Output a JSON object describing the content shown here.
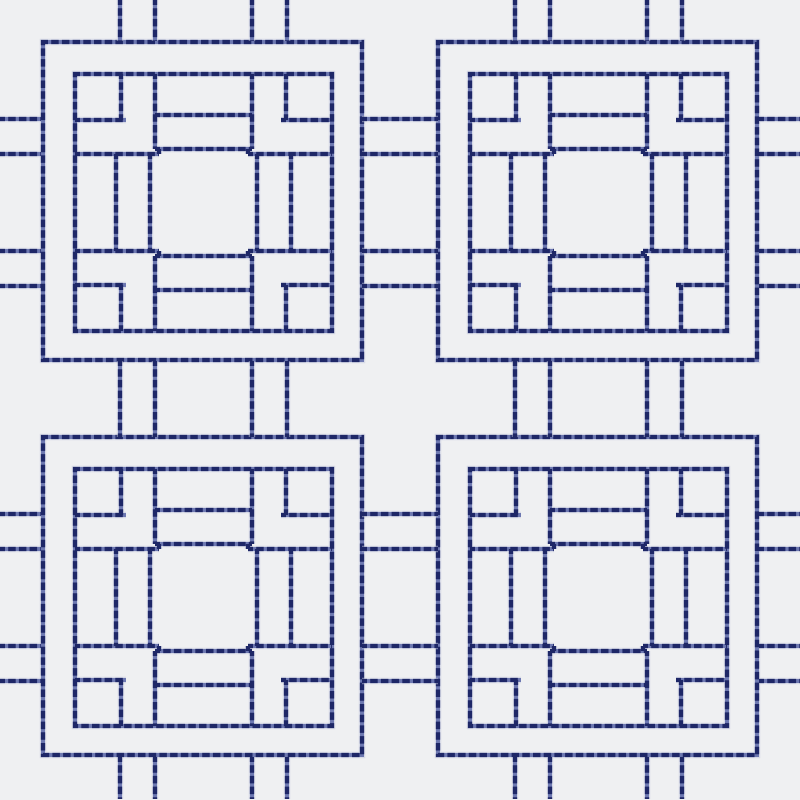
{
  "canvas": {
    "width": 800,
    "height": 800,
    "background": "#eff0f2"
  },
  "thread": {
    "halo_color": "#c5cbdf",
    "halo_width": 6.5,
    "halo_opacity": 0.55,
    "base_color": "#6d78b1",
    "base_width": 4.0,
    "dash_color": "#1e2767",
    "dash_width": 4.3,
    "dash_pattern": "7.5 3.2",
    "dash_offset": 2.5
  },
  "motif": {
    "outer_rect": [
      0,
      0,
      319,
      318
    ],
    "inner_rect": [
      32,
      32,
      257,
      257
    ],
    "segments": [
      [
        78,
        32,
        78,
        78
      ],
      [
        32,
        78,
        83,
        78
      ],
      [
        112,
        32,
        112,
        107
      ],
      [
        32,
        112,
        116,
        112
      ],
      [
        116,
        107,
        116,
        112
      ],
      [
        243,
        32,
        243,
        78
      ],
      [
        238,
        78,
        289,
        78
      ],
      [
        209,
        32,
        209,
        107
      ],
      [
        205,
        112,
        289,
        112
      ],
      [
        205,
        107,
        205,
        112
      ],
      [
        78,
        243,
        78,
        289
      ],
      [
        32,
        243,
        83,
        243
      ],
      [
        112,
        214,
        112,
        289
      ],
      [
        32,
        209,
        116,
        209
      ],
      [
        116,
        209,
        116,
        214
      ],
      [
        243,
        243,
        243,
        289
      ],
      [
        238,
        243,
        289,
        243
      ],
      [
        209,
        214,
        209,
        289
      ],
      [
        205,
        209,
        289,
        209
      ],
      [
        205,
        209,
        205,
        214
      ],
      [
        112,
        73,
        209,
        73
      ],
      [
        112,
        107,
        209,
        107
      ],
      [
        112,
        248,
        209,
        248
      ],
      [
        112,
        214,
        209,
        214
      ],
      [
        73,
        112,
        73,
        209
      ],
      [
        107,
        112,
        107,
        209
      ],
      [
        248,
        112,
        248,
        209
      ],
      [
        214,
        112,
        214,
        209
      ]
    ]
  },
  "motif_origins": [
    [
      43,
      42
    ],
    [
      438,
      42
    ],
    [
      43,
      437
    ],
    [
      438,
      437
    ]
  ],
  "motif_names": [
    "top-left",
    "top-right",
    "bottom-left",
    "bottom-right"
  ],
  "links": {
    "gap_connectors_horizontal": [
      [
        362,
        119,
        438,
        119
      ],
      [
        362,
        154,
        438,
        154
      ],
      [
        362,
        251,
        438,
        251
      ],
      [
        362,
        286,
        438,
        286
      ],
      [
        362,
        514,
        438,
        514
      ],
      [
        362,
        549,
        438,
        549
      ],
      [
        362,
        646,
        438,
        646
      ],
      [
        362,
        681,
        438,
        681
      ]
    ],
    "gap_connectors_vertical": [
      [
        120,
        361,
        120,
        437
      ],
      [
        155,
        361,
        155,
        437
      ],
      [
        252,
        361,
        252,
        437
      ],
      [
        287,
        361,
        287,
        437
      ],
      [
        515,
        361,
        515,
        437
      ],
      [
        550,
        361,
        550,
        437
      ],
      [
        647,
        361,
        647,
        437
      ],
      [
        682,
        361,
        682,
        437
      ]
    ],
    "edge_stubs_left": [
      [
        0,
        119,
        41,
        119
      ],
      [
        0,
        154,
        41,
        154
      ],
      [
        0,
        251,
        41,
        251
      ],
      [
        0,
        286,
        41,
        286
      ],
      [
        0,
        514,
        41,
        514
      ],
      [
        0,
        549,
        41,
        549
      ],
      [
        0,
        646,
        41,
        646
      ],
      [
        0,
        681,
        41,
        681
      ]
    ],
    "edge_stubs_right": [
      [
        759,
        119,
        800,
        119
      ],
      [
        759,
        154,
        800,
        154
      ],
      [
        759,
        251,
        800,
        251
      ],
      [
        759,
        286,
        800,
        286
      ],
      [
        759,
        514,
        800,
        514
      ],
      [
        759,
        549,
        800,
        549
      ],
      [
        759,
        646,
        800,
        646
      ],
      [
        759,
        681,
        800,
        681
      ]
    ],
    "edge_stubs_top": [
      [
        120,
        0,
        120,
        41
      ],
      [
        155,
        0,
        155,
        41
      ],
      [
        252,
        0,
        252,
        41
      ],
      [
        287,
        0,
        287,
        41
      ],
      [
        515,
        0,
        515,
        41
      ],
      [
        550,
        0,
        550,
        41
      ],
      [
        647,
        0,
        647,
        41
      ],
      [
        682,
        0,
        682,
        41
      ]
    ],
    "edge_stubs_bottom": [
      [
        120,
        757,
        120,
        799
      ],
      [
        155,
        757,
        155,
        799
      ],
      [
        252,
        757,
        252,
        799
      ],
      [
        287,
        757,
        287,
        799
      ],
      [
        515,
        757,
        515,
        799
      ],
      [
        550,
        757,
        550,
        799
      ],
      [
        647,
        757,
        647,
        799
      ],
      [
        682,
        757,
        682,
        799
      ]
    ]
  }
}
